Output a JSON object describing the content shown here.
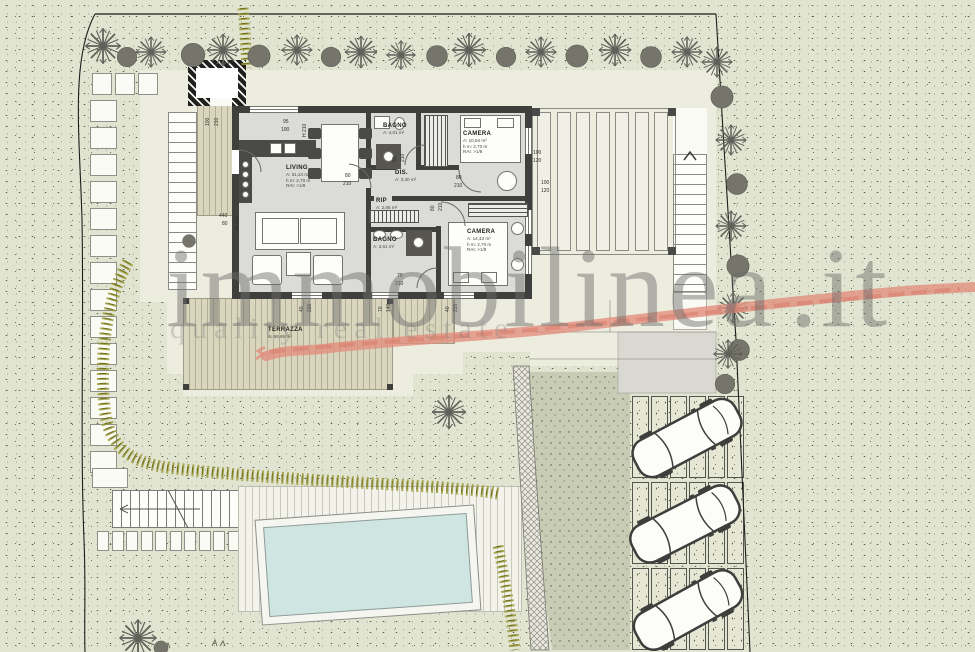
{
  "watermark": {
    "brand": "immobilinea",
    "tld": ".it",
    "tagline": "quality real estate"
  },
  "plan": {
    "rooms": [
      {
        "id": "living",
        "name": "LIVING",
        "line1": "A: 31,24 m²",
        "line2": "h m: 2,70 m",
        "line3": "RAI: >1/8"
      },
      {
        "id": "bagno1",
        "name": "BAGNO",
        "line1": "A: 4,01 m²"
      },
      {
        "id": "dis",
        "name": "DIS.",
        "line1": "A: 3,30 m²"
      },
      {
        "id": "rip",
        "name": "RIP",
        "line1": "A: 2,06 m²"
      },
      {
        "id": "camera1",
        "name": "CAMERA",
        "line1": "A: 10,84 m²",
        "line2": "h m: 2,70 m",
        "line3": "RAI: >1/8"
      },
      {
        "id": "camera2",
        "name": "CAMERA",
        "line1": "A: 14,43 m²",
        "line2": "h m: 2,70 m",
        "line3": "RAI: >1/8"
      },
      {
        "id": "bagno2",
        "name": "BAGNO",
        "line1": "A: 3,61 m²"
      },
      {
        "id": "terrazza",
        "name": "TERRAZZA",
        "line1": "A: 69,89 m²"
      }
    ],
    "dimensions": [
      {
        "t": "100",
        "x": 206,
        "y": 126,
        "r": -90
      },
      {
        "t": "210",
        "x": 215,
        "y": 126,
        "r": -90
      },
      {
        "t": "95",
        "x": 283,
        "y": 120,
        "r": 0
      },
      {
        "t": "100",
        "x": 281,
        "y": 128,
        "r": 0
      },
      {
        "t": "H 210",
        "x": 303,
        "y": 137,
        "r": -90
      },
      {
        "t": "440",
        "x": 219,
        "y": 214,
        "r": 0
      },
      {
        "t": "80",
        "x": 222,
        "y": 222,
        "r": 0
      },
      {
        "t": "H 220",
        "x": 236,
        "y": 230,
        "r": -90
      },
      {
        "t": "80",
        "x": 345,
        "y": 174,
        "r": 0
      },
      {
        "t": "210",
        "x": 343,
        "y": 182,
        "r": 0
      },
      {
        "t": "80",
        "x": 393,
        "y": 162,
        "r": -90
      },
      {
        "t": "210",
        "x": 401,
        "y": 162,
        "r": -90
      },
      {
        "t": "80",
        "x": 456,
        "y": 176,
        "r": 0
      },
      {
        "t": "210",
        "x": 454,
        "y": 184,
        "r": 0
      },
      {
        "t": "80",
        "x": 431,
        "y": 211,
        "r": -90
      },
      {
        "t": "210",
        "x": 439,
        "y": 211,
        "r": -90
      },
      {
        "t": "70",
        "x": 397,
        "y": 274,
        "r": 0
      },
      {
        "t": "210",
        "x": 395,
        "y": 282,
        "r": 0
      },
      {
        "t": "100",
        "x": 533,
        "y": 151,
        "r": 0
      },
      {
        "t": "120",
        "x": 533,
        "y": 159,
        "r": 0
      },
      {
        "t": "100",
        "x": 541,
        "y": 181,
        "r": 0
      },
      {
        "t": "120",
        "x": 541,
        "y": 189,
        "r": 0
      },
      {
        "t": "40",
        "x": 300,
        "y": 312,
        "r": -90
      },
      {
        "t": "220",
        "x": 308,
        "y": 312,
        "r": -90
      },
      {
        "t": "70",
        "x": 379,
        "y": 312,
        "r": -90
      },
      {
        "t": "140",
        "x": 387,
        "y": 312,
        "r": -90
      },
      {
        "t": "40",
        "x": 446,
        "y": 312,
        "r": -90
      },
      {
        "t": "220",
        "x": 454,
        "y": 312,
        "r": -90
      }
    ]
  },
  "colors": {
    "lawn": "#e1e4d0",
    "wall": "#3f3f3d",
    "deck": "#dad6bd",
    "water": "#cfe5e2",
    "swoosh": "#e28f7e",
    "watermark_gray": "#6c6c6a",
    "hedge_olive": "#8f8f35"
  }
}
